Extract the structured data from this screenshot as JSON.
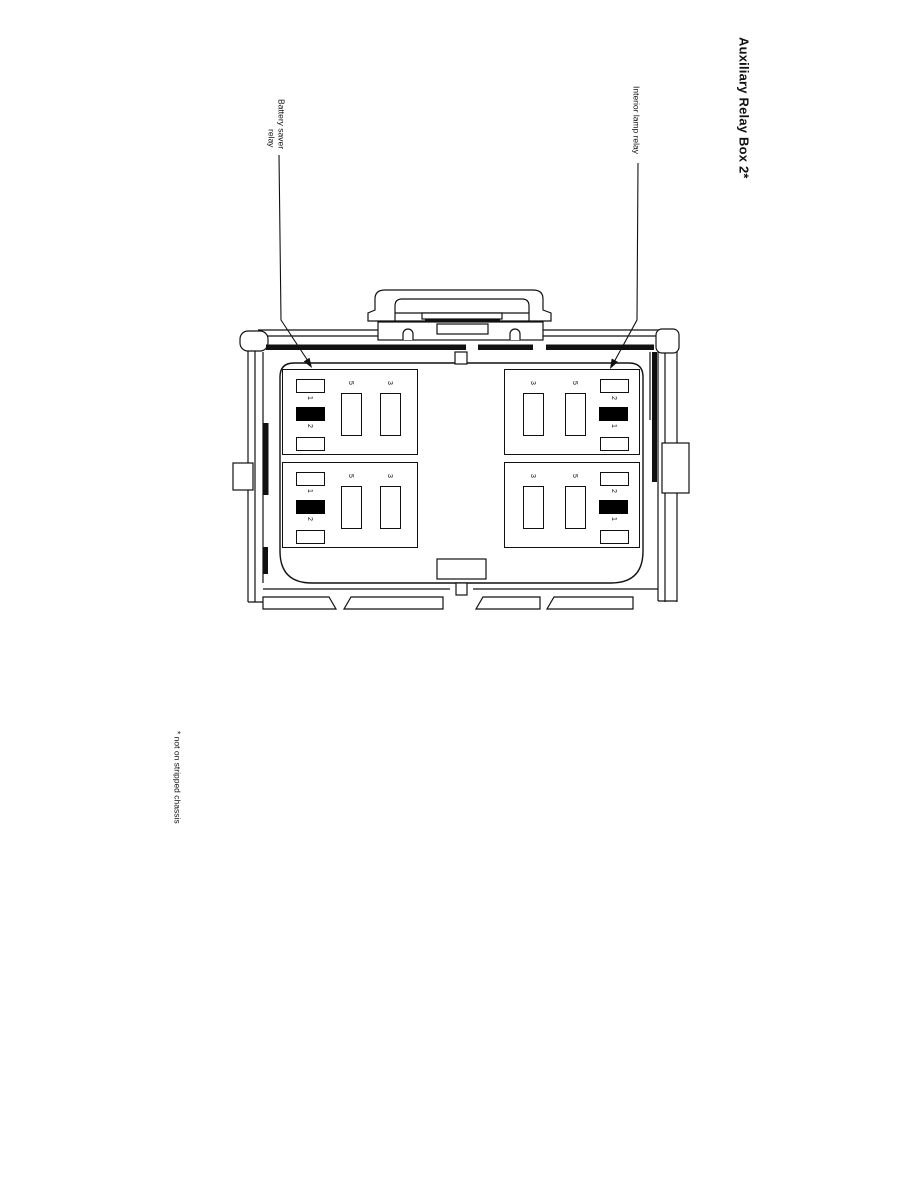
{
  "title": "Auxiliary Relay Box 2*",
  "callouts": {
    "battery": {
      "line1": "Battery saver",
      "line2": "relay"
    },
    "interior": "Interior lamp relay"
  },
  "footnote": "* not on stripped chassis",
  "colors": {
    "ink": "#111111",
    "slot_fill": "#000000",
    "background": "#ffffff"
  },
  "relay_box": {
    "quadrants": [
      {
        "position": "top-left",
        "layout": "edge-left",
        "small_slots": {
          "labels": [
            "1",
            "2"
          ]
        },
        "tall_slots": {
          "labels": [
            "5",
            "3"
          ]
        }
      },
      {
        "position": "top-right",
        "layout": "edge-right",
        "tall_slots": {
          "labels": [
            "3",
            "5"
          ]
        },
        "small_slots": {
          "labels": [
            "2",
            "1"
          ]
        }
      },
      {
        "position": "bottom-left",
        "layout": "edge-left",
        "small_slots": {
          "labels": [
            "1",
            "2"
          ]
        },
        "tall_slots": {
          "labels": [
            "5",
            "3"
          ]
        }
      },
      {
        "position": "bottom-right",
        "layout": "edge-right",
        "tall_slots": {
          "labels": [
            "3",
            "5"
          ]
        },
        "small_slots": {
          "labels": [
            "2",
            "1"
          ]
        }
      }
    ]
  }
}
